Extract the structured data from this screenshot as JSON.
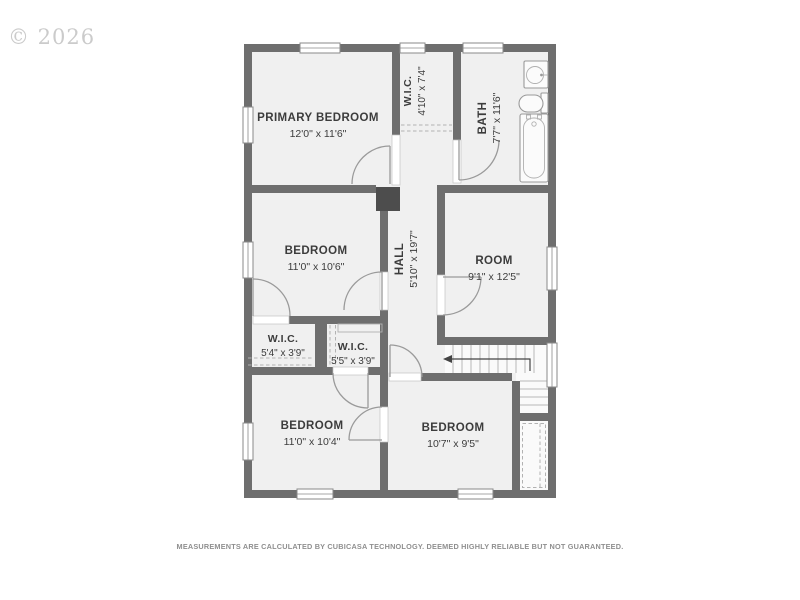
{
  "watermark": "© 2026",
  "disclaimer": "MEASUREMENTS ARE CALCULATED BY CUBICASA TECHNOLOGY. DEEMED HIGHLY RELIABLE BUT NOT GUARANTEED.",
  "colors": {
    "wall": "#6e6e6e",
    "floor": "#f0f0f0",
    "chimney": "#4d4d4d"
  },
  "rooms": {
    "primary_bedroom": {
      "label": "PRIMARY BEDROOM",
      "dims": "12'0\" x 11'6\""
    },
    "wic_upper": {
      "label": "W.I.C.",
      "dims": "4'10\" x 7'4\""
    },
    "bath": {
      "label": "BATH",
      "dims": "7'7\" x 11'6\""
    },
    "bedroom_mid": {
      "label": "BEDROOM",
      "dims": "11'0\" x 10'6\""
    },
    "hall": {
      "label": "HALL",
      "dims": "5'10\" x 19'7\""
    },
    "room": {
      "label": "ROOM",
      "dims": "9'1\" x 12'5\""
    },
    "wic_left": {
      "label": "W.I.C.",
      "dims": "5'4\" x 3'9\""
    },
    "wic_right": {
      "label": "W.I.C.",
      "dims": "5'5\" x 3'9\""
    },
    "bedroom_bl": {
      "label": "BEDROOM",
      "dims": "11'0\" x 10'4\""
    },
    "bedroom_br": {
      "label": "BEDROOM",
      "dims": "10'7\" x 9'5\""
    }
  }
}
